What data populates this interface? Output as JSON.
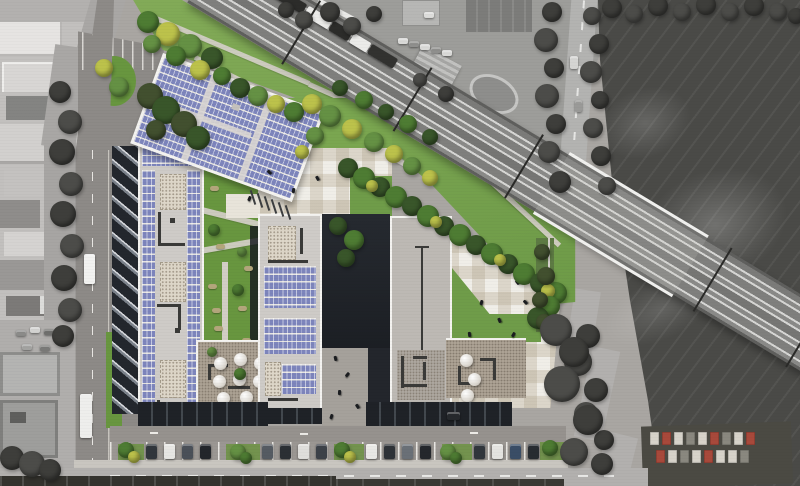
{
  "scene": {
    "type": "aerial-architectural-site-rendering",
    "palette": {
      "asphalt": "#8d8a87",
      "asphalt2": "#96928e",
      "grass": "#6f9c49",
      "grass2": "#7aa650",
      "grassd": "#68963f",
      "solar": "#7d85bc",
      "solargap": "#e7e5e1",
      "roofl": "#cecbc7",
      "roofm": "#bdb9b4",
      "rooft": "#aca294",
      "parapet": "#f4f3f0",
      "struct": "#3a3a38",
      "shadow": "#1f2227",
      "plaza": "#f0eee8",
      "rail": "#8a8a88",
      "railline": "#d6d6d4",
      "field": "#4a4a47",
      "street": "#b2b0ae",
      "tree_g1": "#4e7c33",
      "tree_g2": "#659144",
      "tree_y": "#bcc24b",
      "tree_d": "#39562a",
      "tree_dg": "#42502f",
      "tree_grey": "#3e3e3b",
      "tree_grey2": "#4c4c49",
      "container_w": "#d7d3ca",
      "container_r": "#a8493b",
      "container_g": "#8a887f"
    },
    "railway": {
      "angle_deg": 31,
      "tracks": 4,
      "has_train": true,
      "has_bridge": true,
      "mast_offsets": [
        112,
        242,
        372,
        592,
        700
      ],
      "bridge": {
        "offset": 405,
        "length": 162
      },
      "train_segments": [
        [
          62,
          "#2c2c2a"
        ],
        [
          28,
          "#ebebe9"
        ],
        [
          22,
          "#2c2c2a"
        ],
        [
          20,
          "#ebebe9"
        ],
        [
          30,
          "#323230"
        ]
      ]
    },
    "trees": [
      [
        148,
        22,
        11,
        "g1"
      ],
      [
        168,
        34,
        12,
        "y"
      ],
      [
        190,
        46,
        12,
        "g2"
      ],
      [
        212,
        58,
        11,
        "d"
      ],
      [
        152,
        44,
        9,
        "g2"
      ],
      [
        176,
        56,
        10,
        "g1"
      ],
      [
        200,
        70,
        10,
        "y"
      ],
      [
        222,
        76,
        9,
        "g1"
      ],
      [
        240,
        88,
        10,
        "d"
      ],
      [
        258,
        96,
        10,
        "g2"
      ],
      [
        276,
        104,
        9,
        "y"
      ],
      [
        294,
        112,
        10,
        "g1"
      ],
      [
        312,
        104,
        10,
        "y"
      ],
      [
        330,
        116,
        11,
        "g2"
      ],
      [
        352,
        129,
        10,
        "y"
      ],
      [
        374,
        142,
        10,
        "g2"
      ],
      [
        394,
        154,
        9,
        "y"
      ],
      [
        340,
        88,
        8,
        "d"
      ],
      [
        364,
        100,
        9,
        "g1"
      ],
      [
        386,
        112,
        8,
        "d"
      ],
      [
        408,
        124,
        9,
        "g1"
      ],
      [
        430,
        137,
        8,
        "d"
      ],
      [
        412,
        166,
        9,
        "g2"
      ],
      [
        430,
        178,
        8,
        "y"
      ],
      [
        104,
        68,
        9,
        "y"
      ],
      [
        119,
        87,
        10,
        "g2"
      ],
      [
        315,
        136,
        9,
        "g2"
      ],
      [
        302,
        152,
        7,
        "y"
      ],
      [
        348,
        168,
        10,
        "d"
      ],
      [
        364,
        178,
        11,
        "g1"
      ],
      [
        380,
        187,
        10,
        "d"
      ],
      [
        396,
        197,
        11,
        "g1"
      ],
      [
        412,
        206,
        10,
        "d"
      ],
      [
        428,
        216,
        11,
        "g1"
      ],
      [
        444,
        226,
        10,
        "d"
      ],
      [
        460,
        235,
        11,
        "g1"
      ],
      [
        476,
        245,
        10,
        "d"
      ],
      [
        492,
        254,
        11,
        "g1"
      ],
      [
        508,
        264,
        10,
        "d"
      ],
      [
        524,
        274,
        11,
        "g1"
      ],
      [
        540,
        283,
        10,
        "d"
      ],
      [
        556,
        293,
        11,
        "g1"
      ],
      [
        372,
        186,
        6,
        "y"
      ],
      [
        436,
        222,
        6,
        "y"
      ],
      [
        500,
        260,
        6,
        "y"
      ],
      [
        548,
        291,
        7,
        "y"
      ],
      [
        550,
        306,
        10,
        "g1"
      ],
      [
        538,
        318,
        11,
        "d"
      ],
      [
        552,
        330,
        9,
        "g2"
      ],
      [
        338,
        226,
        9,
        "d"
      ],
      [
        354,
        240,
        10,
        "g1"
      ],
      [
        346,
        258,
        9,
        "d"
      ],
      [
        150,
        96,
        13,
        "dg"
      ],
      [
        166,
        110,
        14,
        "d"
      ],
      [
        184,
        124,
        13,
        "dg"
      ],
      [
        198,
        138,
        12,
        "d"
      ],
      [
        156,
        130,
        10,
        "dg"
      ],
      [
        542,
        252,
        8,
        "dg"
      ],
      [
        546,
        276,
        9,
        "dg"
      ],
      [
        540,
        300,
        8,
        "dg"
      ],
      [
        544,
        322,
        8,
        "dg"
      ],
      [
        126,
        450,
        8,
        "g1"
      ],
      [
        134,
        457,
        6,
        "y"
      ],
      [
        238,
        452,
        8,
        "g2"
      ],
      [
        246,
        458,
        6,
        "g1"
      ],
      [
        342,
        450,
        8,
        "g1"
      ],
      [
        350,
        457,
        6,
        "y"
      ],
      [
        448,
        452,
        8,
        "g2"
      ],
      [
        456,
        458,
        6,
        "g1"
      ],
      [
        550,
        448,
        8,
        "g1"
      ],
      [
        214,
        230,
        6,
        "g1"
      ],
      [
        242,
        252,
        5,
        "g2"
      ],
      [
        238,
        290,
        6,
        "g1"
      ],
      [
        212,
        352,
        5,
        "g2"
      ],
      [
        240,
        374,
        6,
        "g1"
      ],
      [
        552,
        12,
        10,
        "grey"
      ],
      [
        546,
        40,
        12,
        "grey2"
      ],
      [
        554,
        68,
        10,
        "grey"
      ],
      [
        547,
        96,
        12,
        "grey2"
      ],
      [
        556,
        124,
        10,
        "grey"
      ],
      [
        549,
        152,
        11,
        "grey2"
      ],
      [
        560,
        182,
        11,
        "grey"
      ],
      [
        592,
        16,
        9,
        "grey2"
      ],
      [
        599,
        44,
        10,
        "grey"
      ],
      [
        591,
        72,
        11,
        "grey2"
      ],
      [
        600,
        100,
        9,
        "grey"
      ],
      [
        593,
        128,
        10,
        "grey2"
      ],
      [
        601,
        156,
        10,
        "grey"
      ],
      [
        607,
        186,
        9,
        "grey2"
      ],
      [
        588,
        336,
        12,
        "grey"
      ],
      [
        578,
        362,
        14,
        "grey2"
      ],
      [
        596,
        390,
        12,
        "grey"
      ],
      [
        586,
        414,
        12,
        "grey2"
      ],
      [
        604,
        440,
        10,
        "grey"
      ],
      [
        556,
        330,
        16,
        "grey2"
      ],
      [
        574,
        352,
        15,
        "grey"
      ],
      [
        562,
        384,
        18,
        "grey2"
      ],
      [
        588,
        420,
        15,
        "grey"
      ],
      [
        574,
        452,
        14,
        "grey2"
      ],
      [
        602,
        464,
        11,
        "grey"
      ],
      [
        286,
        10,
        8,
        "grey"
      ],
      [
        304,
        20,
        9,
        "grey2"
      ],
      [
        330,
        12,
        10,
        "grey"
      ],
      [
        352,
        26,
        9,
        "grey2"
      ],
      [
        374,
        14,
        8,
        "grey"
      ],
      [
        420,
        80,
        7,
        "grey2"
      ],
      [
        446,
        94,
        8,
        "grey"
      ],
      [
        612,
        8,
        10,
        "grey"
      ],
      [
        634,
        14,
        9,
        "grey2"
      ],
      [
        658,
        6,
        10,
        "grey"
      ],
      [
        682,
        12,
        9,
        "grey2"
      ],
      [
        706,
        5,
        10,
        "grey"
      ],
      [
        730,
        12,
        9,
        "grey2"
      ],
      [
        754,
        6,
        10,
        "grey"
      ],
      [
        778,
        12,
        9,
        "grey2"
      ],
      [
        796,
        16,
        8,
        "grey"
      ],
      [
        60,
        92,
        11,
        "grey"
      ],
      [
        70,
        122,
        12,
        "grey2"
      ],
      [
        62,
        152,
        13,
        "grey"
      ],
      [
        71,
        184,
        12,
        "grey2"
      ],
      [
        63,
        214,
        13,
        "grey"
      ],
      [
        72,
        246,
        12,
        "grey2"
      ],
      [
        64,
        278,
        13,
        "grey"
      ],
      [
        70,
        310,
        12,
        "grey2"
      ],
      [
        63,
        336,
        11,
        "grey"
      ],
      [
        12,
        458,
        12,
        "grey"
      ],
      [
        32,
        464,
        13,
        "grey2"
      ],
      [
        50,
        470,
        11,
        "grey"
      ]
    ],
    "bushes": [
      [
        210,
        186
      ],
      [
        236,
        200
      ],
      [
        216,
        244
      ],
      [
        244,
        266
      ],
      [
        208,
        284
      ],
      [
        238,
        306
      ],
      [
        214,
        326
      ],
      [
        242,
        338
      ],
      [
        226,
        210
      ],
      [
        212,
        308
      ]
    ],
    "people": [
      [
        268,
        170
      ],
      [
        292,
        188
      ],
      [
        316,
        176
      ],
      [
        248,
        196
      ],
      [
        334,
        356
      ],
      [
        346,
        372
      ],
      [
        338,
        390
      ],
      [
        356,
        404
      ],
      [
        330,
        414
      ],
      [
        470,
        240
      ],
      [
        486,
        254
      ],
      [
        502,
        266
      ],
      [
        516,
        280
      ],
      [
        480,
        300
      ],
      [
        498,
        318
      ],
      [
        512,
        332
      ],
      [
        468,
        332
      ],
      [
        524,
        300
      ]
    ],
    "cars": [
      [
        146,
        444,
        11,
        15,
        "#31363c",
        "v",
        "site"
      ],
      [
        164,
        444,
        11,
        15,
        "#e7e6e3",
        "v",
        "site"
      ],
      [
        182,
        444,
        11,
        15,
        "#4a5058",
        "v",
        "site"
      ],
      [
        200,
        444,
        11,
        15,
        "#23262b",
        "v",
        "site"
      ],
      [
        262,
        444,
        11,
        15,
        "#555b62",
        "v",
        "site"
      ],
      [
        280,
        444,
        11,
        15,
        "#2b2f34",
        "v",
        "site"
      ],
      [
        298,
        444,
        11,
        15,
        "#dfdedb",
        "v",
        "site"
      ],
      [
        316,
        444,
        11,
        15,
        "#3c4148",
        "v",
        "site"
      ],
      [
        366,
        444,
        11,
        15,
        "#e9e8e5",
        "v",
        "site"
      ],
      [
        384,
        444,
        11,
        15,
        "#2e3237",
        "v",
        "site"
      ],
      [
        402,
        444,
        11,
        15,
        "#6a7077",
        "v",
        "site"
      ],
      [
        420,
        444,
        11,
        15,
        "#24272c",
        "v",
        "site"
      ],
      [
        474,
        444,
        11,
        15,
        "#31363c",
        "v",
        "site"
      ],
      [
        492,
        444,
        11,
        15,
        "#e4e3e0",
        "v",
        "site"
      ],
      [
        510,
        444,
        11,
        15,
        "#3a4d66",
        "v",
        "site"
      ],
      [
        528,
        444,
        11,
        15,
        "#282c31",
        "v",
        "site"
      ],
      [
        84,
        254,
        11,
        30,
        "#f2f2f0",
        "v",
        "site"
      ],
      [
        80,
        394,
        12,
        44,
        "#eeeeec",
        "v",
        "site"
      ],
      [
        447,
        412,
        13,
        8,
        "#26292d",
        "h",
        "site"
      ],
      [
        398,
        38,
        10,
        6,
        "#d9d9d7",
        "h",
        "bg"
      ],
      [
        409,
        41,
        10,
        6,
        "#8f8f8d",
        "h",
        "bg"
      ],
      [
        420,
        44,
        10,
        6,
        "#d9d9d7",
        "h",
        "bg"
      ],
      [
        431,
        47,
        10,
        6,
        "#8f8f8d",
        "h",
        "bg"
      ],
      [
        442,
        50,
        10,
        6,
        "#d9d9d7",
        "h",
        "bg"
      ],
      [
        424,
        12,
        10,
        6,
        "#dcdcda",
        "h",
        "bg"
      ],
      [
        430,
        112,
        9,
        5,
        "#cfcfcd",
        "h",
        "bg"
      ],
      [
        441,
        117,
        9,
        5,
        "#9a9a98",
        "h",
        "bg"
      ],
      [
        570,
        56,
        8,
        13,
        "#d5d5d3",
        "v",
        "bg"
      ],
      [
        575,
        100,
        7,
        12,
        "#9a9a98",
        "v",
        "bg"
      ],
      [
        16,
        330,
        10,
        6,
        "#8b8b89",
        "h",
        "bg"
      ],
      [
        30,
        327,
        10,
        6,
        "#d2d2d0",
        "h",
        "bg"
      ],
      [
        44,
        329,
        10,
        6,
        "#6f6f6d",
        "h",
        "bg"
      ],
      [
        58,
        331,
        10,
        6,
        "#c4c4c2",
        "h",
        "bg"
      ],
      [
        22,
        344,
        10,
        6,
        "#a3a3a1",
        "h",
        "bg"
      ],
      [
        40,
        345,
        10,
        6,
        "#7a7a78",
        "h",
        "bg"
      ],
      [
        4,
        470,
        10,
        6,
        "#2e2e2c",
        "h",
        "bg"
      ],
      [
        20,
        472,
        10,
        6,
        "#555553",
        "h",
        "bg"
      ],
      [
        38,
        469,
        10,
        6,
        "#3a3a38",
        "h",
        "bg"
      ]
    ],
    "domes_west": [
      [
        16,
        15
      ],
      [
        36,
        11
      ],
      [
        56,
        15
      ],
      [
        15,
        33
      ],
      [
        35,
        31
      ],
      [
        55,
        33
      ],
      [
        19,
        50
      ],
      [
        42,
        49
      ]
    ],
    "domes_east": [
      [
        14,
        14
      ],
      [
        22,
        33
      ],
      [
        15,
        49
      ]
    ],
    "slope_poles": [
      [
        252,
        190
      ],
      [
        259,
        193
      ],
      [
        266,
        196
      ],
      [
        273,
        199
      ],
      [
        280,
        202
      ],
      [
        287,
        205
      ]
    ],
    "containers": [
      [
        650,
        432,
        "w"
      ],
      [
        662,
        432,
        "r"
      ],
      [
        674,
        432,
        "w"
      ],
      [
        686,
        432,
        "g"
      ],
      [
        698,
        432,
        "w"
      ],
      [
        710,
        432,
        "r"
      ],
      [
        722,
        432,
        "g"
      ],
      [
        734,
        432,
        "w"
      ],
      [
        746,
        432,
        "r"
      ],
      [
        656,
        450,
        "r"
      ],
      [
        668,
        450,
        "w"
      ],
      [
        680,
        450,
        "g"
      ],
      [
        692,
        450,
        "w"
      ],
      [
        704,
        450,
        "r"
      ],
      [
        716,
        450,
        "w"
      ],
      [
        728,
        450,
        "w"
      ],
      [
        740,
        450,
        "g"
      ]
    ],
    "verges": [
      [
        118,
        444,
        26,
        18
      ],
      [
        226,
        444,
        34,
        18
      ],
      [
        334,
        444,
        30,
        18
      ],
      [
        442,
        444,
        30,
        18
      ],
      [
        540,
        442,
        26,
        20
      ]
    ]
  }
}
